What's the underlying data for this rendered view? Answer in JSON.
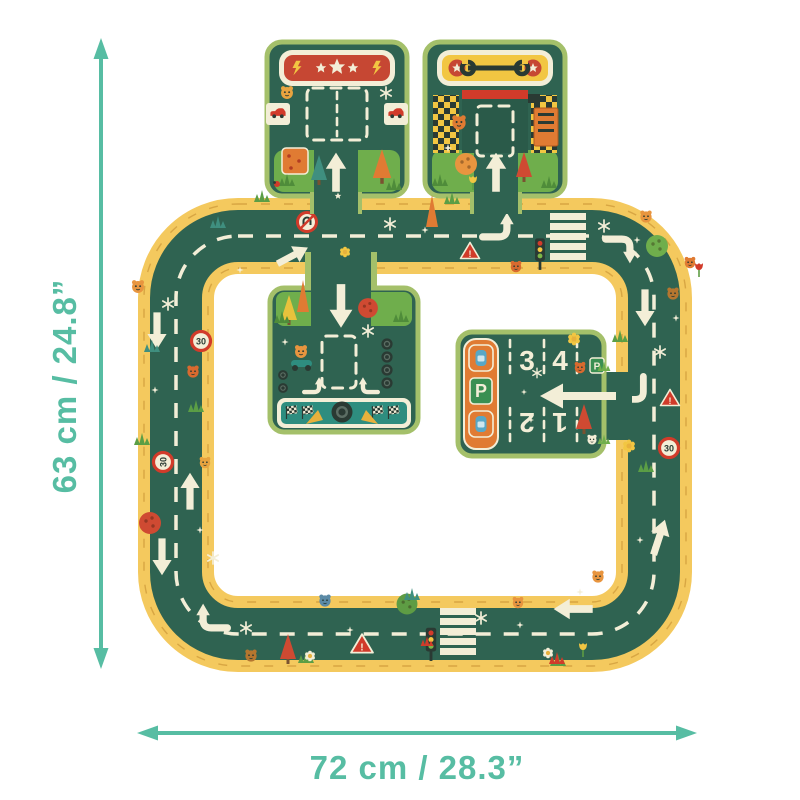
{
  "dimensions": {
    "height_label": "63 cm / 24.8”",
    "width_label": "72 cm / 28.3”"
  },
  "parking": {
    "sign_letter": "P",
    "spot_numbers": [
      "3",
      "4",
      "2",
      "1"
    ]
  },
  "road_signs": {
    "speed_limit": "30",
    "yield_exclamation": "!"
  },
  "colors": {
    "teal": "#57bda3",
    "road-green": "#2f6351",
    "grass-green": "#6fae4c",
    "grass-dark": "#4f8c3a",
    "piece-border": "#a4c06a",
    "border-yellow": "#f4c95e",
    "brick-tan": "#d2a03e",
    "cream": "#f3eed7",
    "banner-red": "#c64733",
    "banner-yellow": "#f2c642",
    "sign-red": "#d13b2a",
    "orange": "#e07b33",
    "finish-teal": "#2e8d7f",
    "car-blue": "#58a7c6",
    "dark": "#2a3a33",
    "spot-green": "#3a8f52"
  }
}
